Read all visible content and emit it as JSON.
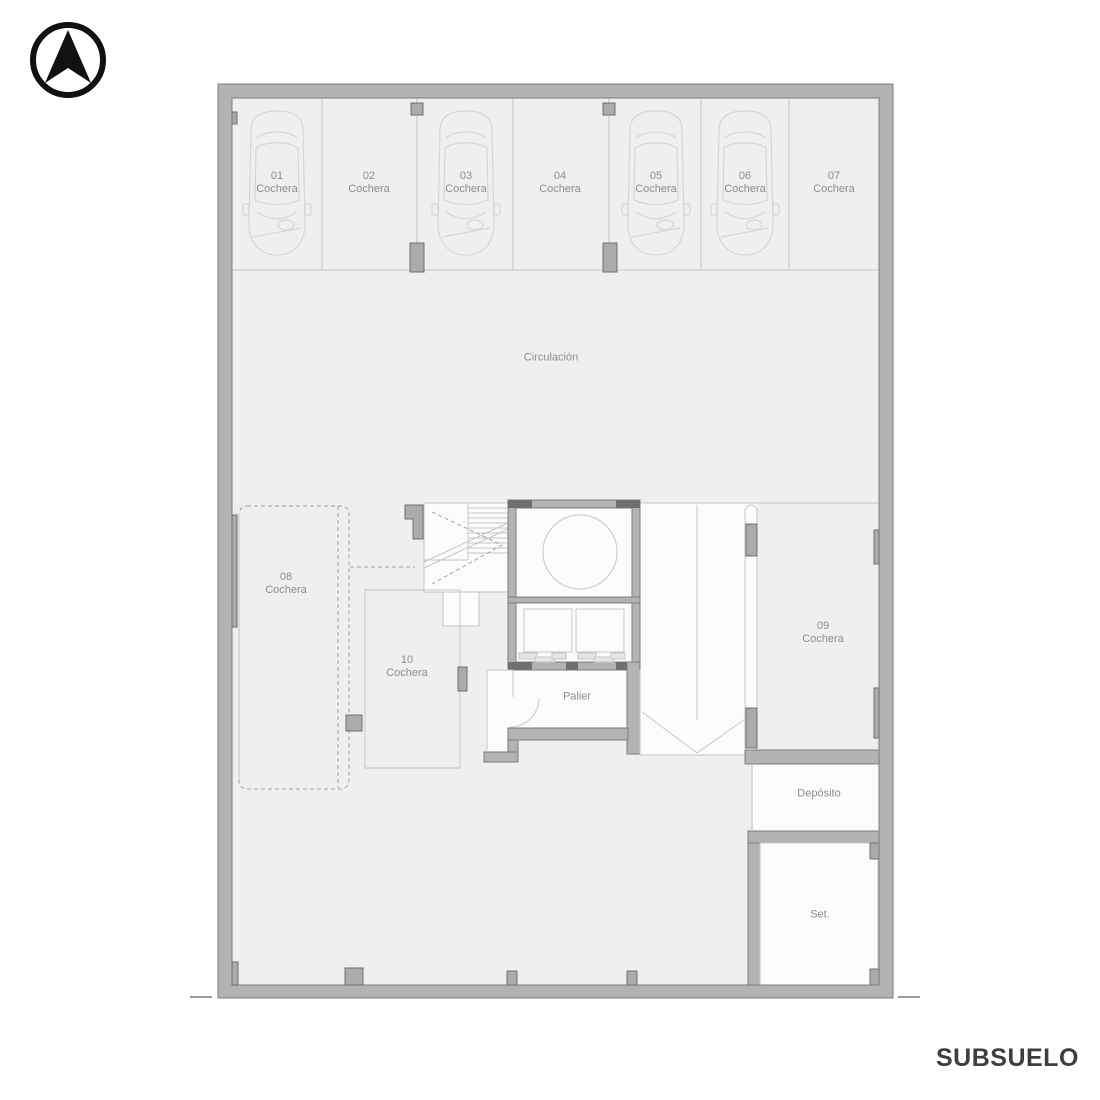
{
  "colors": {
    "wall": "#b3b3b3",
    "wallstroke": "#7d7d7d",
    "floor": "#efefef",
    "room": "#fcfcfc",
    "line": "#c6c6c6",
    "col": "#ababab",
    "dark": "#6f6f6f",
    "label": "#8d8d8d",
    "title": "#3e3e3e",
    "car": "#d6d6d6",
    "dash": "#a2a2a2",
    "black": "#111111"
  },
  "title": {
    "text": "SUBSUELO"
  },
  "compass": {
    "icon": "north-arrow"
  },
  "areas": {
    "circulacion": {
      "label": "Circulación"
    },
    "palier": {
      "label": "Palier"
    },
    "deposito": {
      "label": "Depósito"
    },
    "set": {
      "label": "Set."
    }
  },
  "parking": [
    {
      "num": "01",
      "type": "Cochera",
      "occupied": true
    },
    {
      "num": "02",
      "type": "Cochera",
      "occupied": false
    },
    {
      "num": "03",
      "type": "Cochera",
      "occupied": true
    },
    {
      "num": "04",
      "type": "Cochera",
      "occupied": false
    },
    {
      "num": "05",
      "type": "Cochera",
      "occupied": true
    },
    {
      "num": "06",
      "type": "Cochera",
      "occupied": true
    },
    {
      "num": "07",
      "type": "Cochera",
      "occupied": false
    },
    {
      "num": "08",
      "type": "Cochera",
      "occupied": false
    },
    {
      "num": "09",
      "type": "Cochera",
      "occupied": false
    },
    {
      "num": "10",
      "type": "Cochera",
      "occupied": false
    }
  ]
}
